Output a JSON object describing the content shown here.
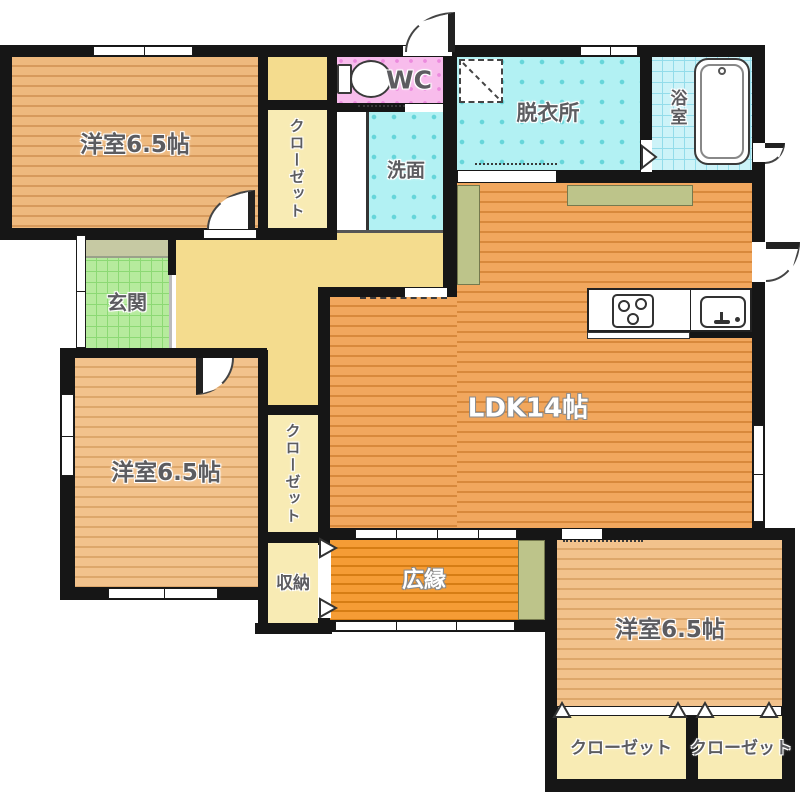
{
  "title": "Japanese apartment floor plan",
  "labels": {
    "room_top_left": "洋室6.5帖",
    "room_bottom_left": "洋室6.5帖",
    "room_bottom_right": "洋室6.5帖",
    "ldk": "LDK14帖",
    "wc": "WC",
    "washroom": "洗面",
    "dressing_room": "脱衣所",
    "bathroom": "浴室",
    "entrance": "玄関",
    "veranda": "広縁",
    "storage": "収納",
    "closet_top": "クローゼット",
    "closet_middle": "クローゼット",
    "closet_bottom_right_1": "クローゼット",
    "closet_bottom_right_2": "クローゼット"
  },
  "palette": {
    "wall": "#161616",
    "wood_room": "#f2c28c",
    "wood_room_dark": "#eeb97e",
    "wood_ldk": "#f1a75e",
    "veranda_orange": "#f59c35",
    "hallway_yellow": "#f4dc8e",
    "closet_yellow": "#f8ebb4",
    "wet_area_cyan": "#b2f1f3",
    "bath_cyan": "#cdf3f8",
    "wc_pink": "#f8bcec",
    "entrance_green": "#b6eb9d",
    "porch_olive": "#c6c9a3",
    "counter_olive": "#bdc48a"
  }
}
